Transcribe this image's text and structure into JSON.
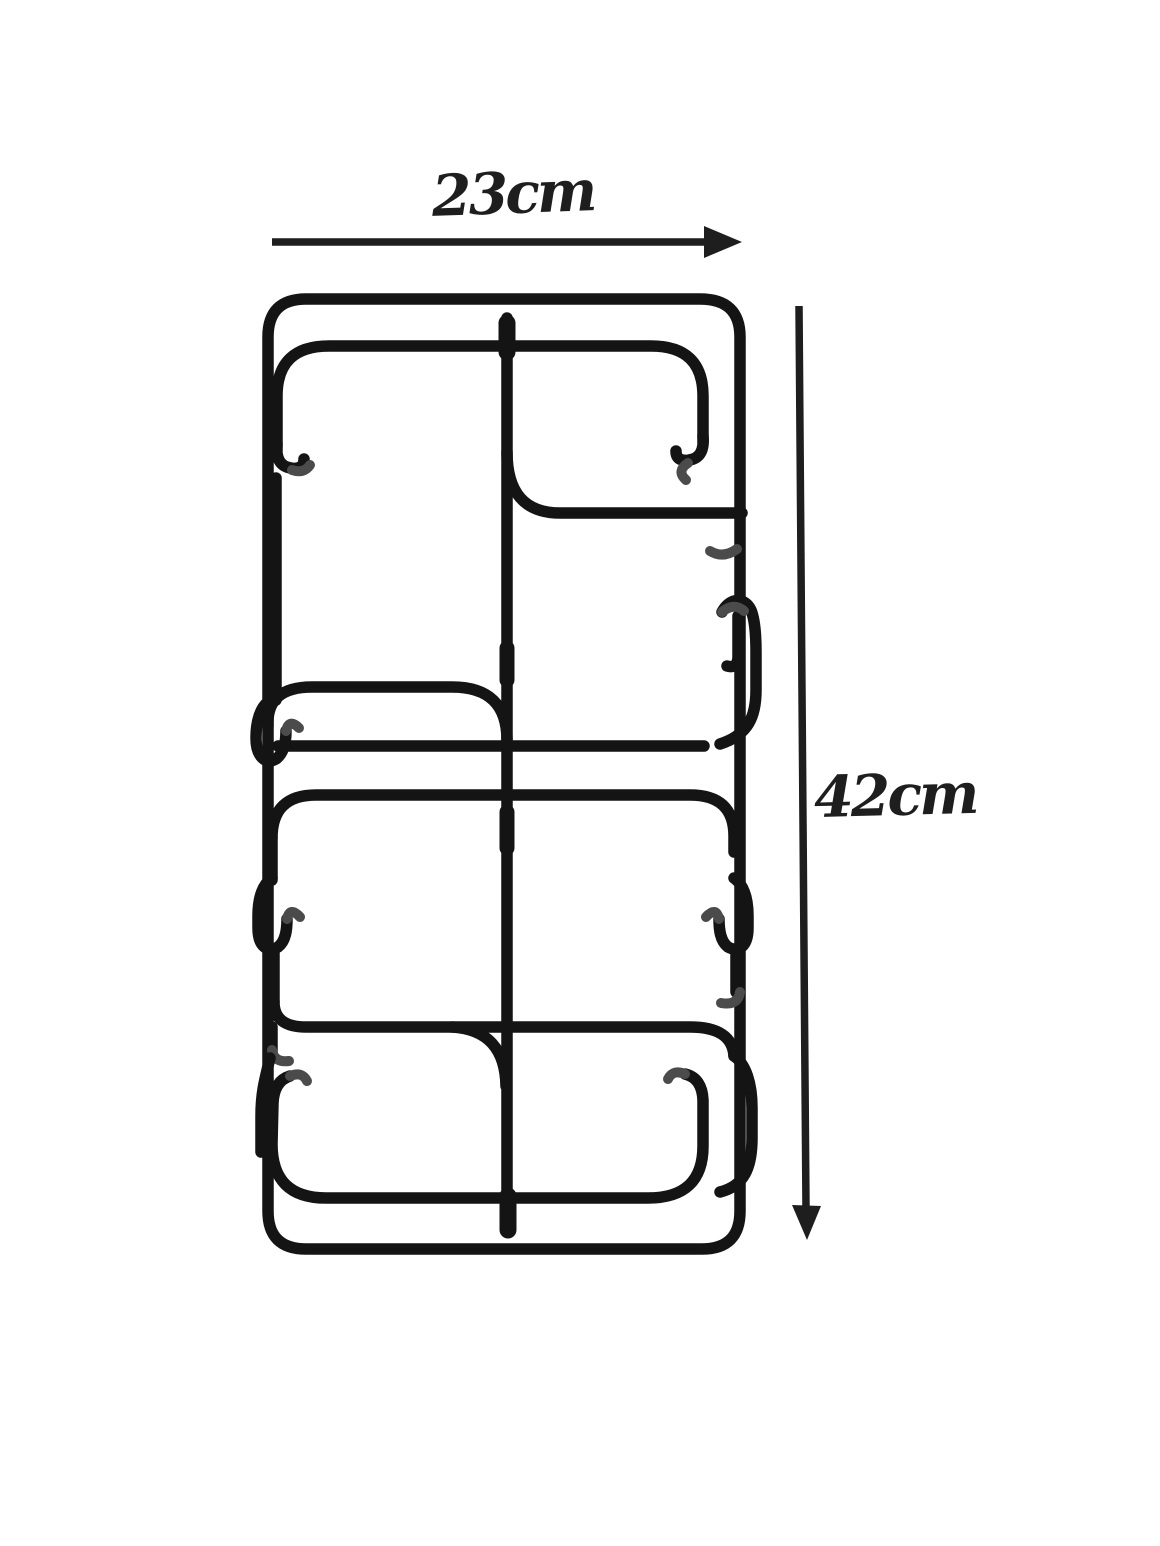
{
  "page": {
    "background_color": "#ffffff"
  },
  "product_photo": {
    "subject": "black wire two-burner stove pan-support grate",
    "wire_color": "#141414",
    "wire_highlight_color": "#4b4b4b"
  },
  "dimension_annotations": {
    "ink_color": "#1e1e1e",
    "width": {
      "label": "23cm",
      "icon": "right-arrow-icon"
    },
    "height": {
      "label": "42cm",
      "icon": "down-arrow-icon"
    }
  }
}
